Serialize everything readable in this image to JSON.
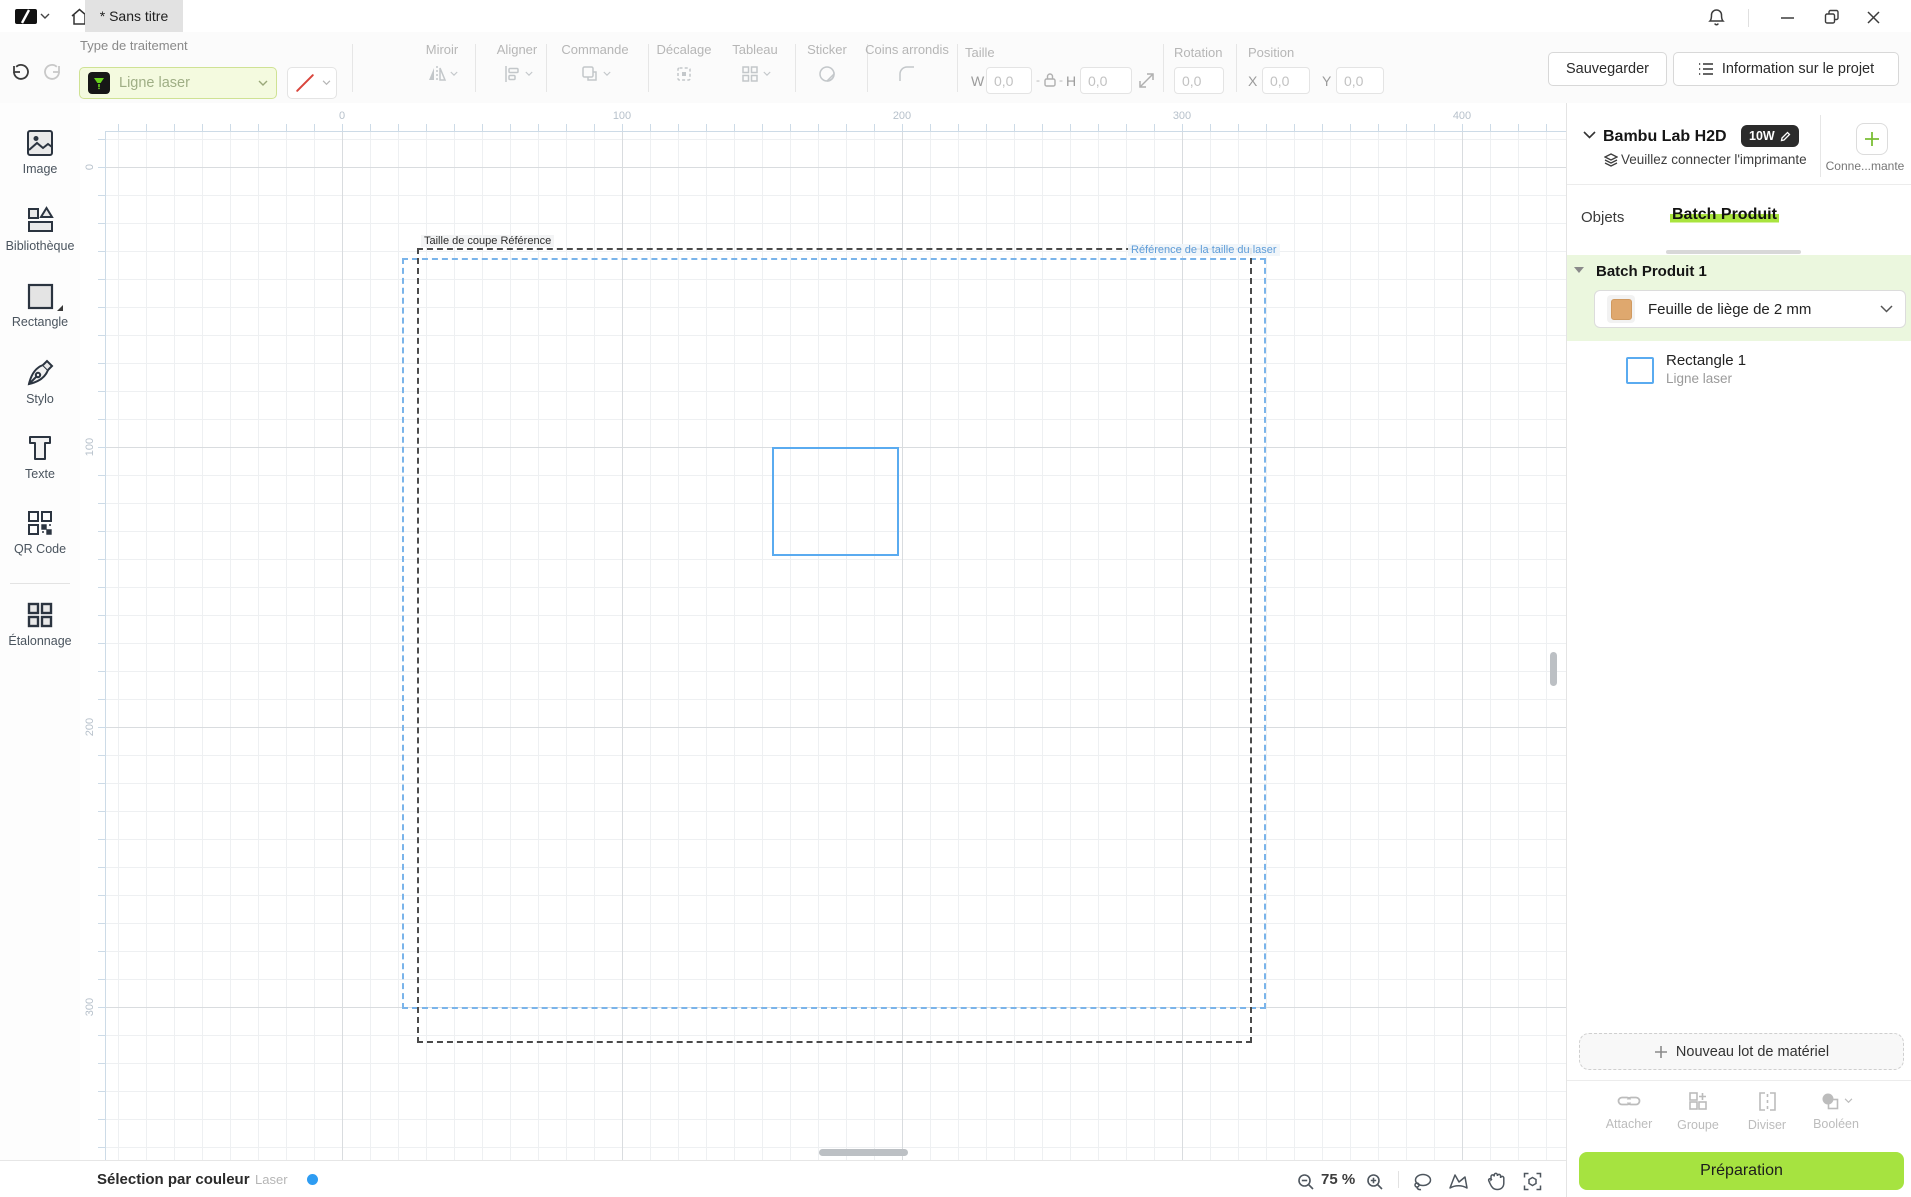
{
  "titlebar": {
    "tab": "* Sans titre"
  },
  "toolbar": {
    "type_label": "Type de traitement",
    "process_value": "Ligne laser",
    "groups": {
      "miroir": "Miroir",
      "aligner": "Aligner",
      "commande": "Commande",
      "decalage": "Décalage",
      "tableau": "Tableau",
      "sticker": "Sticker",
      "coins": "Coins arrondis",
      "taille": "Taille",
      "rotation": "Rotation",
      "position": "Position"
    },
    "fields": {
      "w_label": "W",
      "h_label": "H",
      "x_label": "X",
      "y_label": "Y",
      "w": "0,0",
      "h": "0,0",
      "rotation": "0,0",
      "x": "0,0",
      "y": "0,0"
    },
    "save": "Sauvegarder",
    "project_info": "Information sur le projet"
  },
  "sidebar": {
    "items": [
      {
        "label": "Image"
      },
      {
        "label": "Bibliothèque"
      },
      {
        "label": "Rectangle"
      },
      {
        "label": "Stylo"
      },
      {
        "label": "Texte"
      },
      {
        "label": "QR Code"
      },
      {
        "label": "Étalonnage"
      }
    ]
  },
  "canvas": {
    "h_ruler": [
      "0",
      "100",
      "200",
      "300",
      "400"
    ],
    "v_ruler": [
      "0",
      "100",
      "200",
      "300"
    ],
    "cut_ref_label": "Taille de coupe Référence",
    "laser_ref_label": "Référence de la taille du laser"
  },
  "statusbar": {
    "selection": "Sélection par couleur",
    "laser": "Laser",
    "zoom": "75 %"
  },
  "panel": {
    "device": "Bambu Lab H2D",
    "power": "10W",
    "hint": "Veuillez connecter l'imprimante",
    "connect": "Conne...mante",
    "tabs": {
      "objects": "Objets",
      "batch": "Batch Produit"
    },
    "batch_title": "Batch Produit 1",
    "material": "Feuille de liège de 2 mm",
    "object": {
      "name": "Rectangle 1",
      "type": "Ligne laser"
    },
    "new_material": "Nouveau lot de matériel",
    "actions": [
      {
        "label": "Attacher"
      },
      {
        "label": "Groupe"
      },
      {
        "label": "Diviser"
      },
      {
        "label": "Booléen"
      }
    ],
    "prepare": "Préparation"
  },
  "colors": {
    "accent": "#a6e340",
    "blue": "#5aabf0",
    "cork": "#dfa86e",
    "dot": "#2e9cf2"
  }
}
